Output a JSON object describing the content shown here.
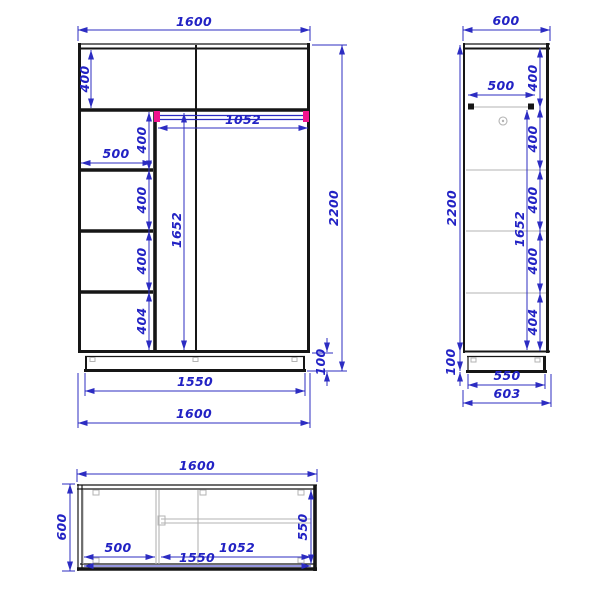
{
  "views": {
    "front": {
      "width_top": "1600",
      "top_height": "400",
      "rod_length": "1052",
      "col_width": "500",
      "cell1": "400",
      "cell2": "400",
      "cell3": "400",
      "cell4": "404",
      "inner_height": "1652",
      "height": "2200",
      "plinth_height": "100",
      "inner_width": "1550",
      "width_bottom": "1600"
    },
    "side": {
      "depth_top": "600",
      "rod_depth": "500",
      "seg1": "400",
      "seg2": "400",
      "seg3": "400",
      "seg4": "400",
      "seg5": "404",
      "inner_height": "1652",
      "height": "2200",
      "plinth_height": "100",
      "plinth_depth": "550",
      "depth_total": "603"
    },
    "top": {
      "width": "1600",
      "depth": "600",
      "col_width": "500",
      "rod_length": "1052",
      "inner_width": "1550",
      "inner_depth": "550"
    }
  },
  "colors": {
    "dimension": "#2c2cc2",
    "outline": "#161616",
    "internal": "#b3b3b3",
    "rod_end": "#f2148e"
  }
}
